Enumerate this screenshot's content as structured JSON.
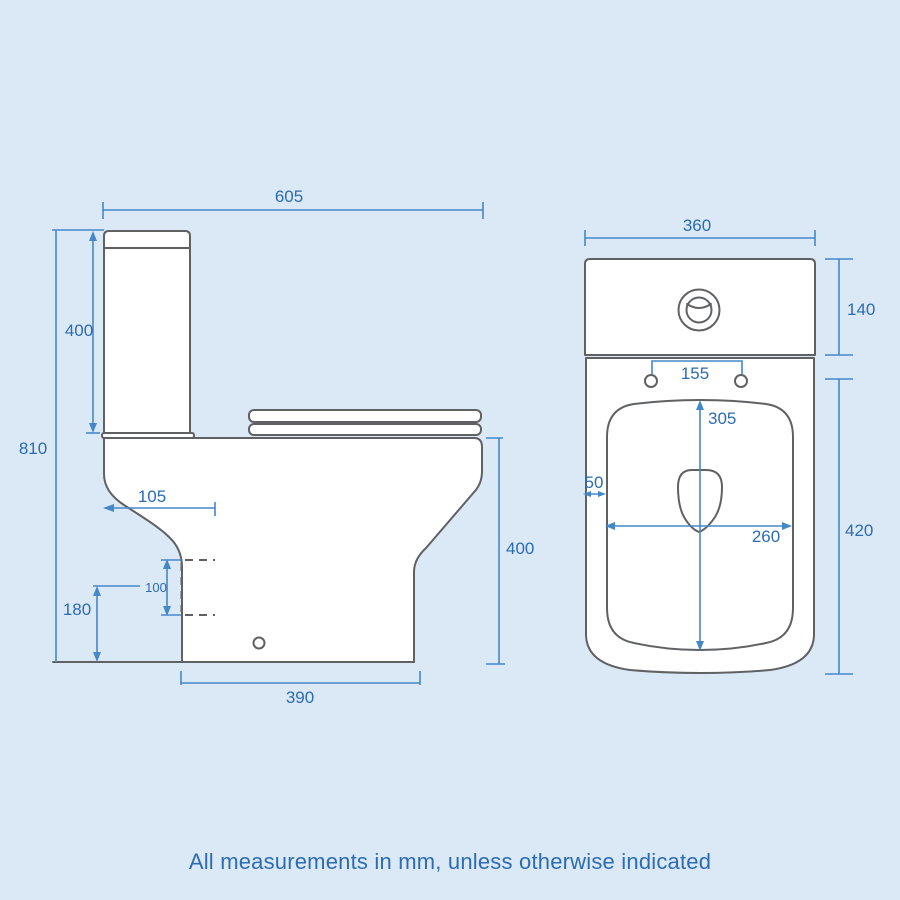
{
  "colors": {
    "background": "#dbe8f5",
    "line": "#5f6163",
    "dim-line": "#4488c8",
    "dim-text": "#2b6cb3"
  },
  "footer_note": "All measurements in mm, unless otherwise indicated",
  "side_view": {
    "overall_depth": "605",
    "cistern_height": "400",
    "overall_height": "810",
    "trap_setout": "105",
    "trap_size": "100",
    "trap_height": "180",
    "base_depth": "390",
    "pan_height": "400"
  },
  "front_view": {
    "overall_width": "360",
    "cistern_face_height": "140",
    "hinge_centres": "155",
    "bowl_length": "305",
    "rim_offset": "50",
    "bowl_width": "260",
    "pan_height": "420"
  }
}
